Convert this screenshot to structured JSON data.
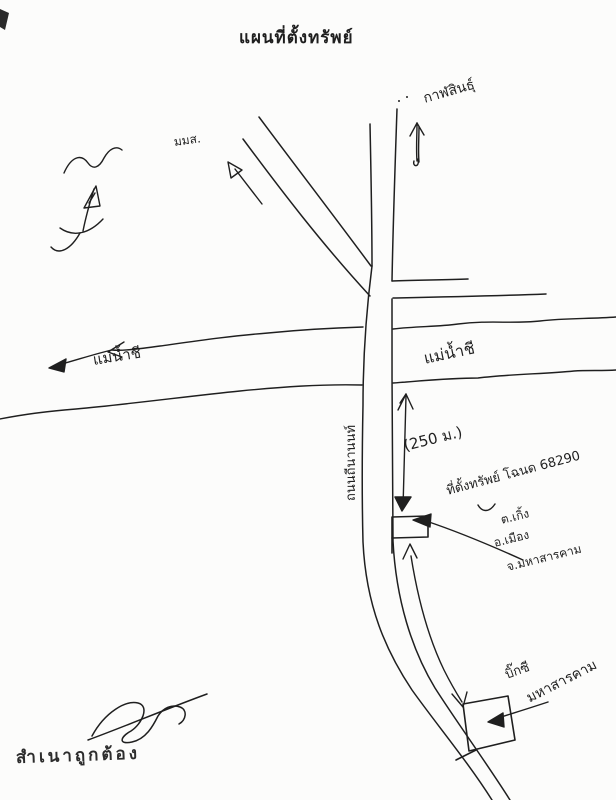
{
  "title": "แผนที่ตั้งทรัพย์",
  "directions": {
    "north_destination": "กาฬสินธุ์",
    "university": "มมส."
  },
  "river": {
    "label_west": "แม่น้ำชี",
    "label_east": "แม่น้ำชี"
  },
  "road": {
    "name": "ถนนถีนานนท์"
  },
  "measurement": {
    "distance": "(250 ม.)"
  },
  "property": {
    "label": "ที่ตั้งทรัพย์ โฉนด 68290",
    "subdistrict": "ต.เกิ้ง",
    "district": "อ.เมือง",
    "province": "จ.มหาสารคาม"
  },
  "landmark": {
    "name": "บิ๊กซี",
    "city": "มหาสารคาม"
  },
  "certification": {
    "text": "สำเนาถูกต้อง"
  },
  "colors": {
    "ink": "#1f1f1f",
    "paper": "#fcfcfb"
  }
}
